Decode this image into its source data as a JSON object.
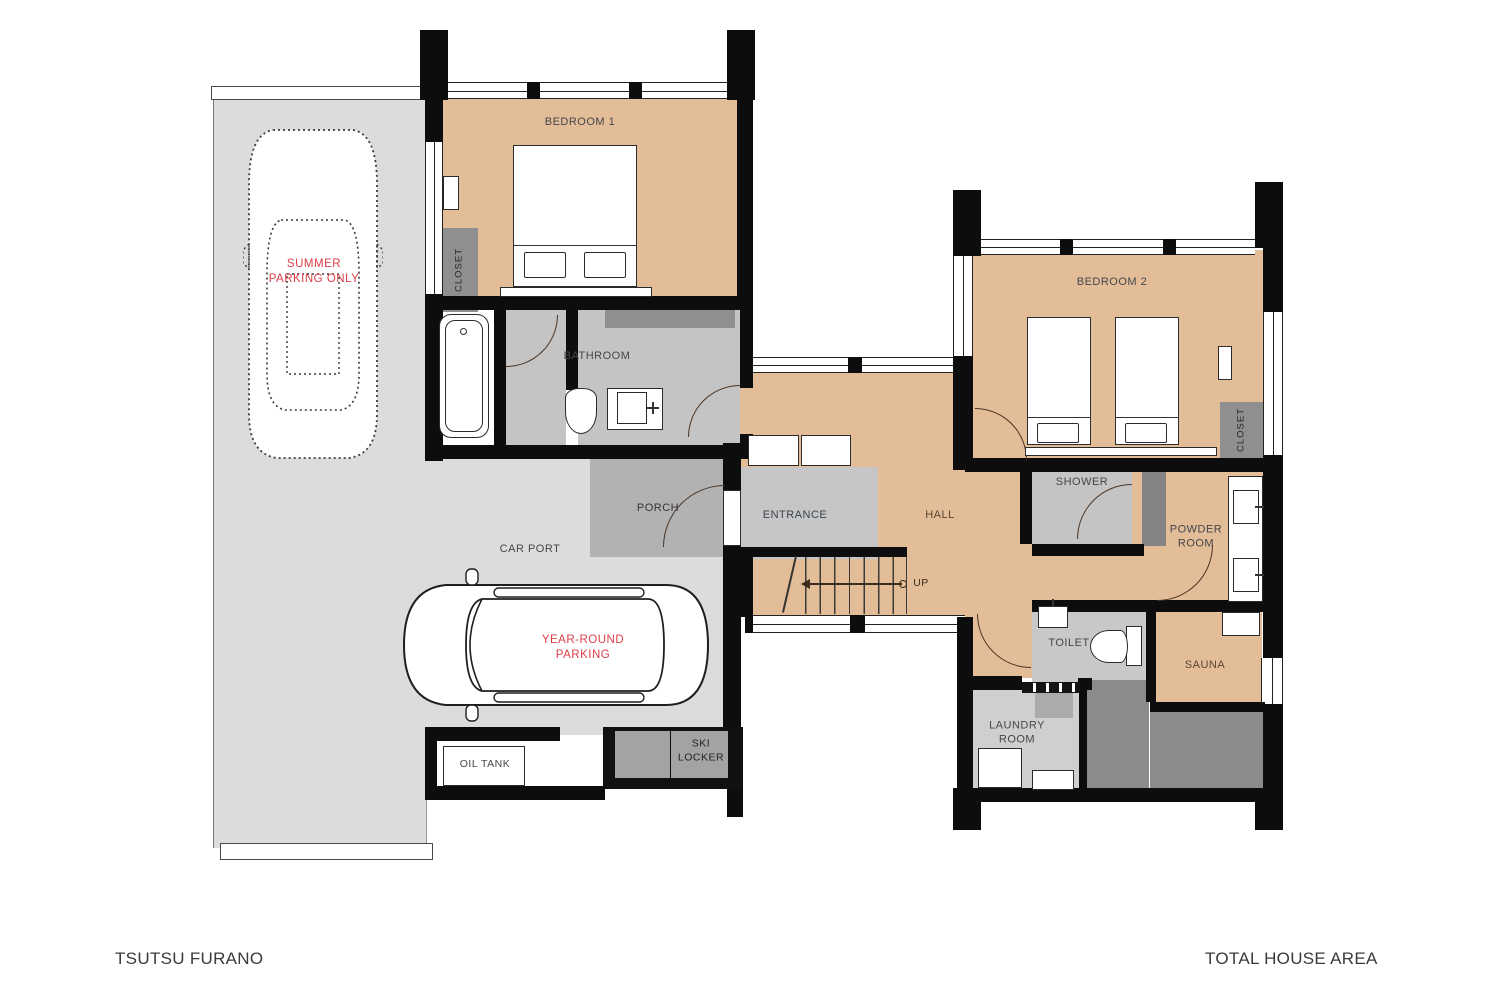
{
  "title_block": {
    "project": "TSUTSU FURANO",
    "floor": "FIRST FLOOR"
  },
  "area_block": {
    "label": "TOTAL HOUSE AREA",
    "value": "168 m²"
  },
  "rooms": {
    "bedroom1": "BEDROOM 1",
    "bedroom2": "BEDROOM 2",
    "bathroom": "BATHROOM",
    "closet1": "CLOSET",
    "closet2": "CLOSET",
    "porch": "PORCH",
    "carport": "CAR PORT",
    "entrance": "ENTRANCE",
    "hall": "HALL",
    "shower": "SHOWER",
    "powder_room": "POWDER\nROOM",
    "toilet": "TOILET",
    "sauna": "SAUNA",
    "laundry_room": "LAUNDRY\nROOM",
    "ski_locker": "SKI\nLOCKER",
    "oil_tank": "OIL TANK"
  },
  "annotations": {
    "summer_parking": "SUMMER\nPARKING ONLY",
    "year_round_parking": "YEAR-ROUND\nPARKING",
    "stairs_up": "UP"
  },
  "colors": {
    "floor_tan": "#e2bd97",
    "wall_black": "#0d0d0d",
    "parking_gray": "#dcdcdc",
    "annotation_red": "#dd3e46"
  }
}
